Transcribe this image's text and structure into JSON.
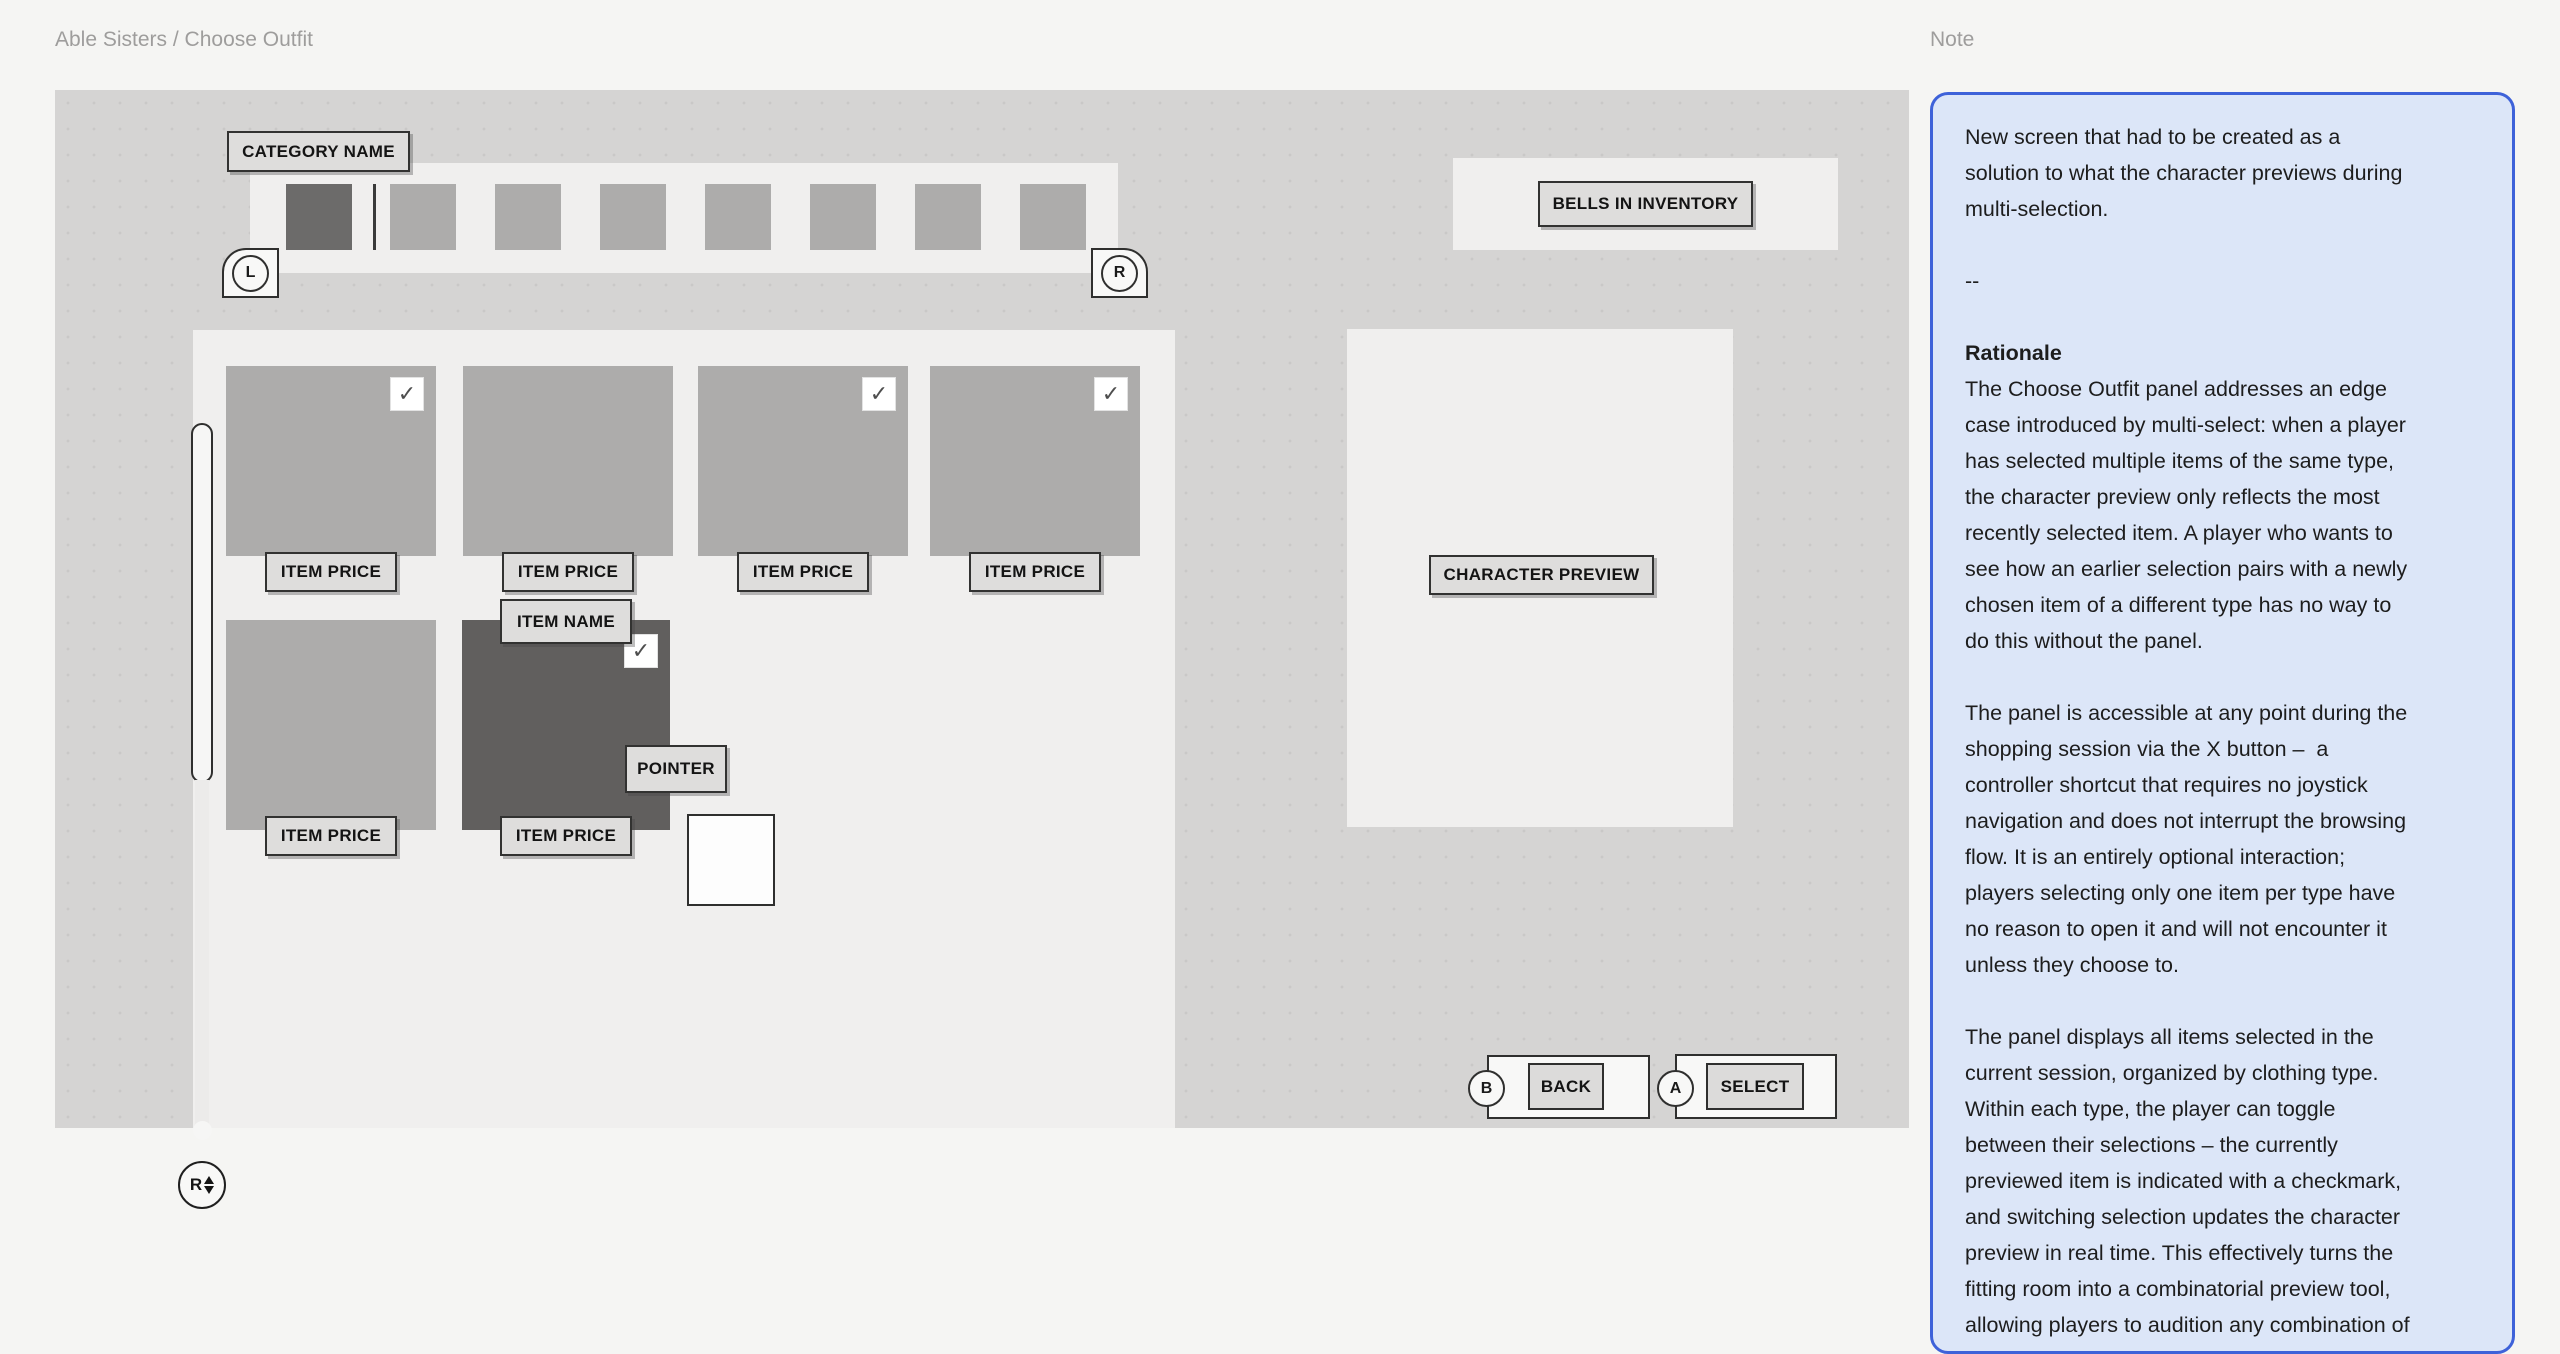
{
  "breadcrumb": "Able Sisters / Choose Outfit",
  "colors": {
    "page_bg": "#f5f5f3",
    "artboard_bg": "#d5d4d3",
    "panel_bg": "#f0efee",
    "tile_gray": "#adacab",
    "tile_dark": "#615f5e",
    "label_fill": "#dedddc",
    "outline": "#2f2f2e",
    "note_fill": "#dce6f8",
    "note_border": "#3e62d9"
  },
  "canvas": {
    "category": {
      "label": "CATEGORY NAME",
      "left_shoulder": "L",
      "right_shoulder": "R",
      "thumbnail_count": 8,
      "selected_thumbnail_index": 0
    },
    "grid": {
      "check_icon": "✓",
      "items": [
        {
          "price_label": "ITEM PRICE",
          "checked": true
        },
        {
          "price_label": "ITEM PRICE",
          "checked": false
        },
        {
          "price_label": "ITEM PRICE",
          "checked": true
        },
        {
          "price_label": "ITEM PRICE",
          "checked": true
        },
        {
          "price_label": "ITEM PRICE",
          "checked": false
        },
        {
          "price_label": "ITEM PRICE",
          "checked": true,
          "name_label": "ITEM NAME",
          "highlighted": true
        }
      ],
      "pointer_label": "POINTER"
    },
    "bells_label": "BELLS IN INVENTORY",
    "preview_label": "CHARACTER PREVIEW",
    "actions": {
      "back_button_key": "B",
      "back_label": "BACK",
      "select_button_key": "A",
      "select_label": "SELECT"
    },
    "scroll_stick_key": "R"
  },
  "note": {
    "title": "Note",
    "intro": "New screen that had to be created as a\nsolution to what the character previews during\nmulti-selection.",
    "divider": "--",
    "rationale_heading": "Rationale",
    "rationale_body": "The Choose Outfit panel addresses an edge\ncase introduced by multi-select: when a player\nhas selected multiple items of the same type,\nthe character preview only reflects the most\nrecently selected item. A player who wants to\nsee how an earlier selection pairs with a newly\nchosen item of a different type has no way to\ndo this without the panel.",
    "para_accessibility": "The panel is accessible at any point during the\nshopping session via the X button –  a\ncontroller shortcut that requires no joystick\nnavigation and does not interrupt the browsing\nflow. It is an entirely optional interaction;\nplayers selecting only one item per type have\nno reason to open it and will not encounter it\nunless they choose to.",
    "para_display": "The panel displays all items selected in the\ncurrent session, organized by clothing type.\nWithin each type, the player can toggle\nbetween their selections – the currently\npreviewed item is indicated with a checkmark,\nand switching selection updates the character\npreview in real time. This effectively turns the\nfitting room into a combinatorial preview tool,\nallowing players to audition any combination of\ntheir session selections before committing to a"
  }
}
